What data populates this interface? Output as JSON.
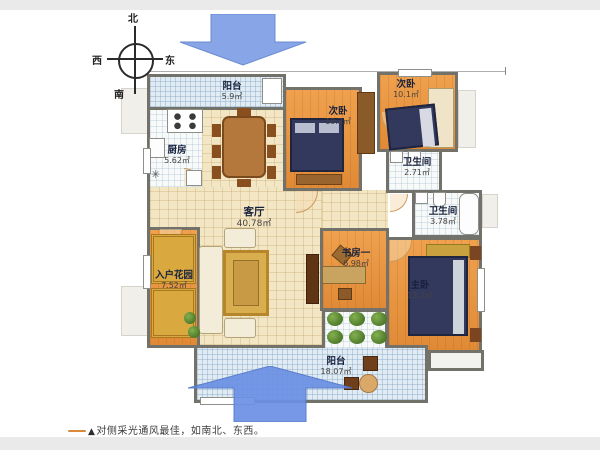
{
  "compass": {
    "north": "北",
    "south": "南",
    "east": "东",
    "west": "西"
  },
  "rooms": {
    "balcony_top": {
      "name": "阳台",
      "area": "5.9㎡"
    },
    "kitchen": {
      "name": "厨房",
      "area": "5.62㎡"
    },
    "bedroom_mid": {
      "name": "次卧",
      "area": "10.2㎡"
    },
    "bedroom_right": {
      "name": "次卧",
      "area": "10.1㎡"
    },
    "bath_small": {
      "name": "卫生间",
      "area": "2.71㎡"
    },
    "bath_big": {
      "name": "卫生间",
      "area": "3.78㎡"
    },
    "living": {
      "name": "客厅",
      "area": "40.78㎡"
    },
    "study": {
      "name": "书房一",
      "area": "6.98㎡"
    },
    "master": {
      "name": "主卧",
      "area": "13.2㎡"
    },
    "garden": {
      "name": "入户花园",
      "area": "7.52㎡"
    },
    "balcony_bottom": {
      "name": "阳台",
      "area": "18.07㎡"
    }
  },
  "caption": {
    "marker": "▲",
    "text": "对侧采光通风最佳，如南北、东西。"
  },
  "colors": {
    "arrow": "#7b9ce8",
    "wall": "#72726a",
    "floor_orange": "#e89040",
    "floor_beige": "#f3e6c4",
    "floor_blue": "#e0ebf3",
    "accent_line": "#d98a3a"
  }
}
